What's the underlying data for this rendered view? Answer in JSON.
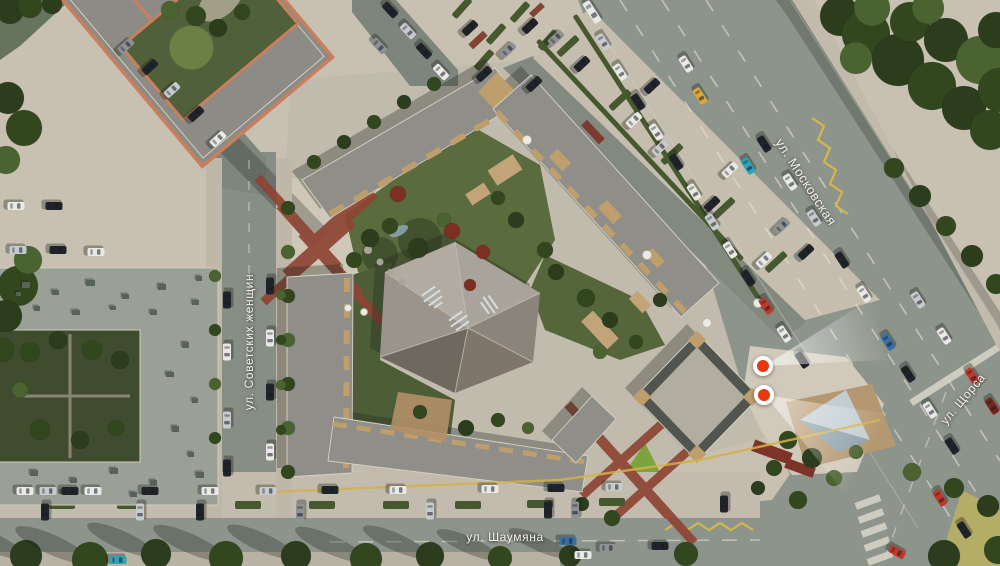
{
  "streets": [
    {
      "id": "sovetskikh-zhenshchin",
      "label": "ул. Советских женщин"
    },
    {
      "id": "moskovskaya",
      "label": "ул. Московская"
    },
    {
      "id": "shaumyana",
      "label": "ул. Шаумяна"
    },
    {
      "id": "shchorsa",
      "label": "ул. Щорса"
    }
  ],
  "markers": [
    {
      "id": "viewpoint-1",
      "color": "#e8380d"
    },
    {
      "id": "viewpoint-2",
      "color": "#e8380d"
    }
  ],
  "palette": {
    "pavement": "#c8c1b2",
    "road": "#8d948b",
    "roof": "#8f8e88",
    "wood": "#bf9e6e",
    "orange_parapet": "#c97f5d",
    "red_paving": "#8e4434",
    "marker_red": "#e8380d",
    "yellow_line": "#d2b24a",
    "hedge": "#46582e",
    "car_colors": {
      "white": "#e9e9e6",
      "black": "#20242a",
      "gray": "#8e9294",
      "silver": "#c7cbcd",
      "red": "#c0392b",
      "darkred": "#7c241c",
      "blue": "#3a6ea5",
      "teal": "#2fa3b8",
      "yellow": "#d9a93b"
    },
    "tree_colors": {
      "d": "#33471f",
      "a": "#2b3d1c",
      "b": "#4a6330",
      "r": "#7c2f22",
      "g": "#5d7a36"
    }
  },
  "scene": {
    "cars": [
      [
        592,
        12,
        57,
        "white",
        24
      ],
      [
        603,
        42,
        57,
        "silver"
      ],
      [
        620,
        72,
        57,
        "white"
      ],
      [
        638,
        102,
        57,
        "black"
      ],
      [
        656,
        132,
        57,
        "white"
      ],
      [
        686,
        64,
        57,
        "white"
      ],
      [
        700,
        96,
        57,
        "yellow"
      ],
      [
        676,
        162,
        57,
        "black"
      ],
      [
        694,
        192,
        57,
        "white"
      ],
      [
        712,
        222,
        57,
        "silver"
      ],
      [
        730,
        250,
        57,
        "white"
      ],
      [
        748,
        278,
        57,
        "black"
      ],
      [
        766,
        306,
        57,
        "red"
      ],
      [
        784,
        334,
        57,
        "white"
      ],
      [
        802,
        360,
        57,
        "black"
      ],
      [
        748,
        166,
        57,
        "teal"
      ],
      [
        764,
        144,
        57,
        "black"
      ],
      [
        790,
        182,
        57,
        "white"
      ],
      [
        814,
        218,
        57,
        "silver"
      ],
      [
        842,
        260,
        57,
        "black"
      ],
      [
        864,
        294,
        57,
        "white"
      ],
      [
        888,
        342,
        57,
        "blue"
      ],
      [
        908,
        374,
        57,
        "black"
      ],
      [
        930,
        410,
        57,
        "white"
      ],
      [
        952,
        446,
        57,
        "black"
      ],
      [
        972,
        376,
        57,
        "red"
      ],
      [
        992,
        406,
        57,
        "darkred"
      ],
      [
        940,
        498,
        57,
        "red"
      ],
      [
        964,
        530,
        57,
        "black"
      ],
      [
        897,
        552,
        30,
        "red"
      ],
      [
        918,
        300,
        57,
        "silver"
      ],
      [
        944,
        336,
        57,
        "white"
      ],
      [
        25,
        491,
        0,
        "white"
      ],
      [
        48,
        491,
        0,
        "silver"
      ],
      [
        70,
        491,
        0,
        "black"
      ],
      [
        93,
        491,
        0,
        "white"
      ],
      [
        150,
        491,
        0,
        "black"
      ],
      [
        210,
        491,
        0,
        "white"
      ],
      [
        268,
        491,
        0,
        "silver"
      ],
      [
        330,
        490,
        0,
        "black"
      ],
      [
        398,
        490,
        0,
        "white"
      ],
      [
        490,
        489,
        0,
        "white"
      ],
      [
        556,
        488,
        0,
        "black"
      ],
      [
        614,
        487,
        0,
        "silver"
      ],
      [
        45,
        512,
        90,
        "black"
      ],
      [
        140,
        512,
        90,
        "silver"
      ],
      [
        200,
        512,
        90,
        "black"
      ],
      [
        300,
        512,
        90,
        "gray"
      ],
      [
        430,
        511,
        90,
        "silver"
      ],
      [
        548,
        510,
        90,
        "black"
      ],
      [
        575,
        510,
        90,
        "gray"
      ],
      [
        724,
        504,
        90,
        "black"
      ],
      [
        118,
        560,
        0,
        "teal"
      ],
      [
        583,
        555,
        0,
        "white"
      ],
      [
        608,
        548,
        0,
        "gray"
      ],
      [
        568,
        541,
        0,
        "blue"
      ],
      [
        660,
        546,
        0,
        "black"
      ],
      [
        227,
        300,
        90,
        "black"
      ],
      [
        227,
        352,
        90,
        "white"
      ],
      [
        227,
        420,
        90,
        "silver"
      ],
      [
        227,
        468,
        90,
        "black"
      ],
      [
        270,
        286,
        90,
        "black"
      ],
      [
        270,
        338,
        90,
        "white"
      ],
      [
        270,
        392,
        90,
        "black"
      ],
      [
        270,
        452,
        90,
        "white"
      ],
      [
        150,
        67,
        -42,
        "black"
      ],
      [
        172,
        90,
        -42,
        "silver"
      ],
      [
        196,
        114,
        -42,
        "black"
      ],
      [
        218,
        139,
        -42,
        "white"
      ],
      [
        126,
        46,
        -42,
        "gray"
      ],
      [
        390,
        10,
        47,
        "black"
      ],
      [
        408,
        31,
        47,
        "silver"
      ],
      [
        424,
        51,
        47,
        "black"
      ],
      [
        441,
        72,
        47,
        "white"
      ],
      [
        379,
        46,
        47,
        "gray"
      ],
      [
        16,
        206,
        0,
        "white"
      ],
      [
        54,
        206,
        0,
        "black"
      ],
      [
        18,
        250,
        0,
        "silver"
      ],
      [
        58,
        250,
        0,
        "black"
      ],
      [
        96,
        252,
        0,
        "white"
      ],
      [
        470,
        28,
        -43,
        "black"
      ],
      [
        530,
        26,
        -43,
        "black"
      ],
      [
        508,
        50,
        -43,
        "gray"
      ],
      [
        484,
        74,
        -43,
        "black"
      ],
      [
        534,
        84,
        -43,
        "black"
      ],
      [
        556,
        38,
        -43,
        "gray"
      ],
      [
        582,
        64,
        -43,
        "black"
      ],
      [
        634,
        120,
        -43,
        "white"
      ],
      [
        660,
        148,
        -43,
        "silver"
      ],
      [
        712,
        204,
        -43,
        "black"
      ],
      [
        764,
        260,
        -43,
        "white"
      ],
      [
        652,
        86,
        -43,
        "black"
      ],
      [
        730,
        170,
        -43,
        "white"
      ],
      [
        782,
        226,
        -43,
        "gray"
      ],
      [
        806,
        252,
        -43,
        "black"
      ]
    ],
    "trees": [
      [
        840,
        16,
        20,
        "a"
      ],
      [
        866,
        34,
        24,
        "d"
      ],
      [
        898,
        60,
        26,
        "a"
      ],
      [
        932,
        86,
        24,
        "d"
      ],
      [
        964,
        108,
        22,
        "a"
      ],
      [
        990,
        130,
        20,
        "d"
      ],
      [
        872,
        8,
        18,
        "b"
      ],
      [
        910,
        22,
        20,
        "d"
      ],
      [
        946,
        40,
        22,
        "a"
      ],
      [
        980,
        60,
        24,
        "b"
      ],
      [
        1000,
        90,
        22,
        "d"
      ],
      [
        856,
        58,
        16,
        "b"
      ],
      [
        996,
        30,
        18,
        "a"
      ],
      [
        928,
        8,
        16,
        "b"
      ],
      [
        894,
        168,
        10,
        "d"
      ],
      [
        920,
        196,
        11,
        "a"
      ],
      [
        946,
        226,
        10,
        "d"
      ],
      [
        972,
        256,
        11,
        "a"
      ],
      [
        996,
        284,
        10,
        "d"
      ],
      [
        8,
        98,
        16,
        "a"
      ],
      [
        24,
        128,
        18,
        "d"
      ],
      [
        6,
        160,
        14,
        "b"
      ],
      [
        18,
        286,
        20,
        "d"
      ],
      [
        6,
        316,
        16,
        "a"
      ],
      [
        28,
        260,
        14,
        "b"
      ],
      [
        2,
        350,
        12,
        "d"
      ],
      [
        288,
        208,
        7,
        "d"
      ],
      [
        288,
        252,
        7,
        "b"
      ],
      [
        288,
        296,
        7,
        "d"
      ],
      [
        288,
        340,
        7,
        "b"
      ],
      [
        288,
        384,
        7,
        "d"
      ],
      [
        288,
        428,
        7,
        "b"
      ],
      [
        288,
        472,
        7,
        "d"
      ],
      [
        215,
        276,
        6,
        "b"
      ],
      [
        215,
        330,
        6,
        "d"
      ],
      [
        215,
        384,
        6,
        "b"
      ],
      [
        215,
        438,
        6,
        "d"
      ],
      [
        26,
        556,
        16,
        "a",
        1
      ],
      [
        90,
        560,
        18,
        "d",
        1
      ],
      [
        156,
        554,
        15,
        "a",
        1
      ],
      [
        226,
        558,
        17,
        "d",
        1
      ],
      [
        296,
        556,
        15,
        "a",
        1
      ],
      [
        366,
        559,
        16,
        "d",
        1
      ],
      [
        430,
        556,
        14,
        "a",
        1
      ],
      [
        500,
        558,
        12,
        "d",
        1
      ],
      [
        570,
        556,
        11,
        "a",
        1
      ],
      [
        686,
        554,
        12,
        "d"
      ],
      [
        944,
        556,
        16,
        "a"
      ],
      [
        998,
        550,
        14,
        "d"
      ],
      [
        912,
        472,
        9,
        "b"
      ],
      [
        954,
        488,
        10,
        "d"
      ],
      [
        988,
        506,
        11,
        "a"
      ],
      [
        788,
        440,
        9,
        "d"
      ],
      [
        812,
        458,
        10,
        "a"
      ],
      [
        774,
        468,
        8,
        "d"
      ],
      [
        834,
        478,
        8,
        "b"
      ],
      [
        798,
        500,
        9,
        "d"
      ],
      [
        758,
        488,
        7,
        "a"
      ],
      [
        856,
        452,
        7,
        "b"
      ],
      [
        370,
        238,
        9,
        "a"
      ],
      [
        390,
        226,
        8,
        "d"
      ],
      [
        418,
        248,
        10,
        "a"
      ],
      [
        354,
        260,
        8,
        "d"
      ],
      [
        444,
        220,
        7,
        "b"
      ],
      [
        498,
        198,
        7,
        "d"
      ],
      [
        516,
        220,
        8,
        "a"
      ],
      [
        545,
        250,
        8,
        "d"
      ],
      [
        398,
        194,
        8,
        "r"
      ],
      [
        452,
        231,
        8,
        "r"
      ],
      [
        483,
        252,
        7,
        "r"
      ],
      [
        470,
        285,
        6,
        "r"
      ],
      [
        314,
        162,
        7,
        "d"
      ],
      [
        344,
        142,
        7,
        "a"
      ],
      [
        374,
        122,
        7,
        "d"
      ],
      [
        404,
        102,
        7,
        "a"
      ],
      [
        434,
        84,
        7,
        "d"
      ],
      [
        556,
        272,
        8,
        "a"
      ],
      [
        586,
        298,
        9,
        "d"
      ],
      [
        610,
        320,
        8,
        "a"
      ],
      [
        636,
        342,
        7,
        "d"
      ],
      [
        600,
        352,
        7,
        "b"
      ],
      [
        660,
        300,
        7,
        "a"
      ],
      [
        420,
        412,
        7,
        "d"
      ],
      [
        466,
        428,
        8,
        "a"
      ],
      [
        498,
        420,
        7,
        "d"
      ],
      [
        528,
        428,
        6,
        "b"
      ],
      [
        30,
        352,
        10,
        "d"
      ],
      [
        58,
        340,
        9,
        "a"
      ],
      [
        92,
        350,
        10,
        "d"
      ],
      [
        120,
        360,
        9,
        "a"
      ],
      [
        40,
        430,
        10,
        "d"
      ],
      [
        80,
        440,
        9,
        "a"
      ],
      [
        116,
        428,
        8,
        "d"
      ],
      [
        20,
        390,
        8,
        "b"
      ],
      [
        196,
        16,
        10,
        "d"
      ],
      [
        218,
        28,
        9,
        "a"
      ],
      [
        242,
        12,
        8,
        "d"
      ],
      [
        170,
        10,
        9,
        "b"
      ],
      [
        612,
        518,
        8,
        "d"
      ],
      [
        582,
        504,
        7,
        "a"
      ],
      [
        281,
        295,
        5,
        "b"
      ],
      [
        281,
        340,
        5,
        "d"
      ],
      [
        281,
        385,
        5,
        "b"
      ],
      [
        281,
        430,
        5,
        "d"
      ],
      [
        10,
        10,
        14,
        "a"
      ],
      [
        30,
        6,
        12,
        "d"
      ],
      [
        52,
        4,
        10,
        "a"
      ]
    ],
    "hedges": [
      [
        670,
        162,
        350,
        5,
        57
      ],
      [
        640,
        150,
        300,
        5,
        47
      ],
      [
        568,
        46,
        26,
        7,
        -43
      ],
      [
        620,
        100,
        26,
        7,
        -43
      ],
      [
        672,
        154,
        26,
        7,
        -43
      ],
      [
        724,
        208,
        26,
        7,
        -43
      ],
      [
        776,
        262,
        26,
        7,
        -43
      ],
      [
        462,
        8,
        24,
        7,
        -48
      ],
      [
        496,
        34,
        24,
        7,
        -48
      ],
      [
        520,
        12,
        24,
        7,
        -48
      ],
      [
        548,
        40,
        24,
        7,
        -48
      ],
      [
        484,
        60,
        24,
        7,
        -48
      ],
      [
        62,
        505,
        26,
        8,
        0
      ],
      [
        130,
        505,
        26,
        8,
        0
      ],
      [
        248,
        505,
        26,
        8,
        0
      ],
      [
        322,
        505,
        26,
        8,
        0
      ],
      [
        396,
        505,
        26,
        8,
        0
      ],
      [
        468,
        505,
        26,
        8,
        0
      ],
      [
        540,
        504,
        26,
        8,
        0
      ],
      [
        612,
        502,
        26,
        8,
        0
      ]
    ],
    "roof_units": [
      [
        22,
        282,
        8,
        6
      ],
      [
        52,
        290,
        7,
        5
      ],
      [
        86,
        280,
        9,
        6
      ],
      [
        122,
        294,
        7,
        5
      ],
      [
        158,
        284,
        8,
        6
      ],
      [
        192,
        300,
        7,
        5
      ],
      [
        34,
        306,
        6,
        5
      ],
      [
        72,
        310,
        8,
        5
      ],
      [
        110,
        306,
        6,
        4
      ],
      [
        150,
        310,
        7,
        5
      ],
      [
        196,
        276,
        6,
        5
      ],
      [
        182,
        342,
        7,
        6
      ],
      [
        166,
        372,
        8,
        5
      ],
      [
        192,
        398,
        6,
        5
      ],
      [
        172,
        426,
        7,
        6
      ],
      [
        188,
        452,
        6,
        5
      ],
      [
        30,
        470,
        8,
        6
      ],
      [
        70,
        478,
        7,
        5
      ],
      [
        110,
        468,
        8,
        6
      ],
      [
        150,
        480,
        7,
        5
      ],
      [
        196,
        472,
        8,
        6
      ],
      [
        60,
        490,
        6,
        4
      ],
      [
        130,
        492,
        7,
        5
      ],
      [
        205,
        490,
        6,
        5
      ],
      [
        16,
        292,
        5,
        4
      ]
    ]
  }
}
